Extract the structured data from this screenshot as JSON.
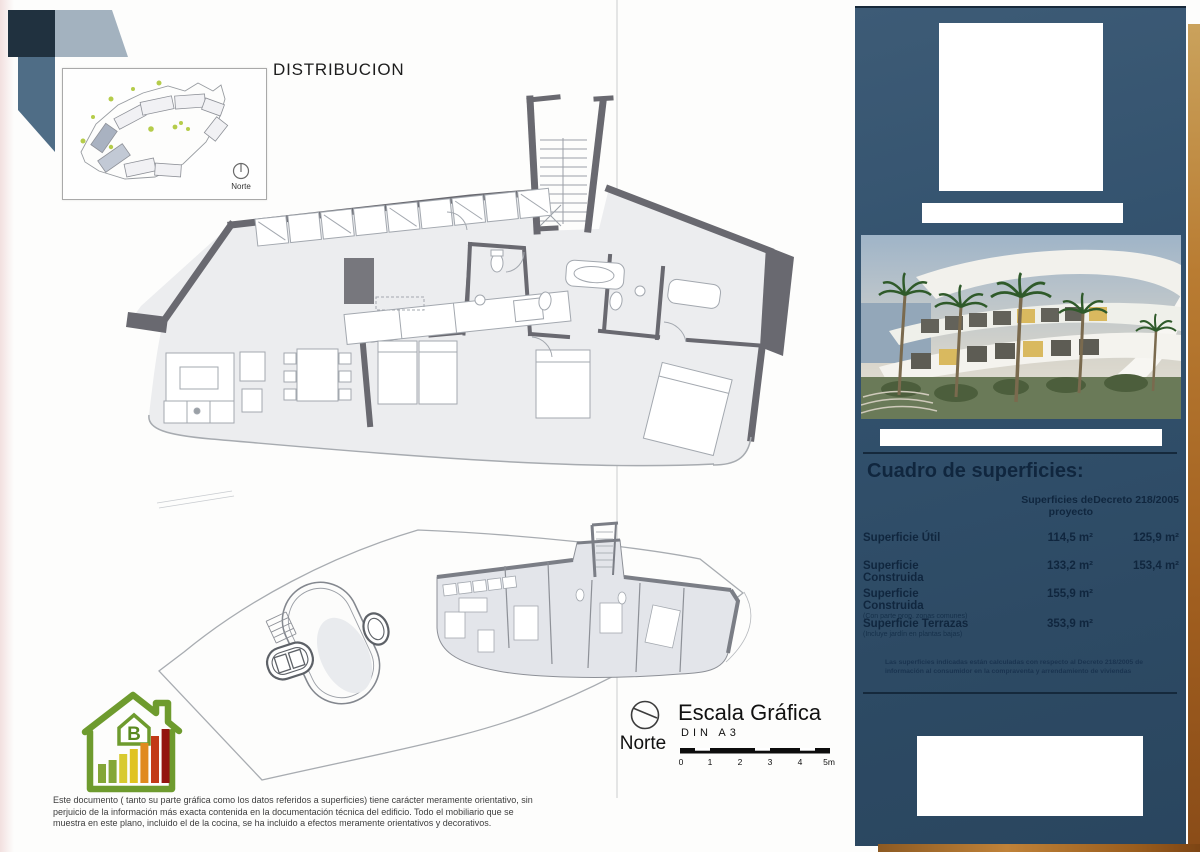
{
  "page": {
    "title": "DISTRIBUCION",
    "inset_north_label": "Norte",
    "scale": {
      "title": "Escala Gráfica",
      "din": "DIN A3",
      "ticks": [
        "0",
        "1",
        "2",
        "3",
        "4",
        "5m"
      ],
      "north_label": "Norte"
    },
    "energy_rating": "B",
    "disclaimer": "Este documento ( tanto su parte gráfica como los datos referidos a superficies) tiene carácter meramente orientativo, sin perjuicio de la información más exacta contenida en la documentación técnica del edificio. Todo el mobiliario que se muestra en este plano, incluido el de la cocina, se ha incluido a efectos meramente orientativos y decorativos."
  },
  "sidebar": {
    "surfaces_table": {
      "title": "Cuadro de superficies:",
      "col_project": "Superficies de proyecto",
      "col_decreto": "Decreto 218/2005",
      "rows": [
        {
          "label": "Superficie Útil",
          "sub": "",
          "project": "114,5 m²",
          "decreto": "125,9 m²"
        },
        {
          "label": "Superficie Construida",
          "sub": "",
          "project": "133,2 m²",
          "decreto": "153,4 m²"
        },
        {
          "label": "Superficie Construida",
          "sub": "(Con parte prop. zonas comunes)",
          "project": "155,9 m²",
          "decreto": ""
        },
        {
          "label": "Superficie Terrazas",
          "sub": "(Incluye jardín en plantas bajas)",
          "project": "353,9 m²",
          "decreto": ""
        }
      ],
      "footnote": "Las superficies indicadas están calculadas con respecto al Decreto 218/2005 de información al consumidor en la compraventa y arrendamiento de viviendas"
    },
    "colors": {
      "panel": "#32516d",
      "wood": "#a96a2c",
      "energy_green": "#6e9b2e"
    }
  }
}
